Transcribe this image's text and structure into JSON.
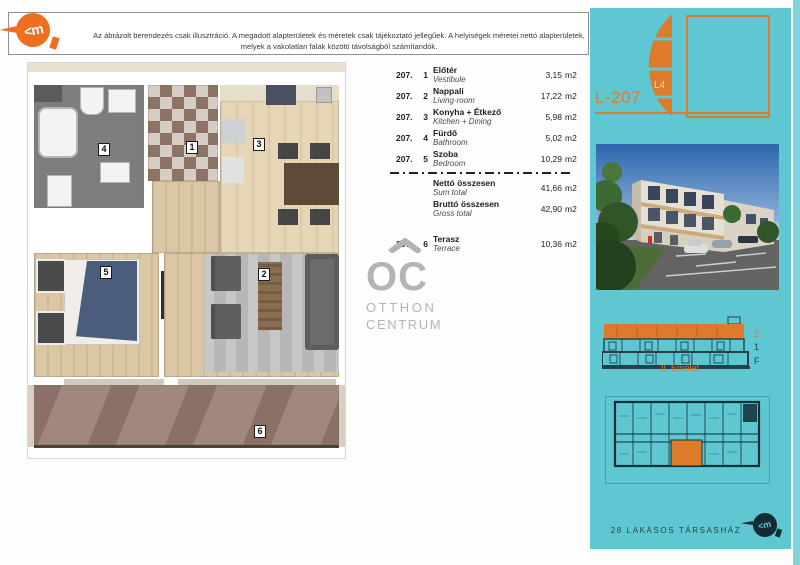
{
  "header": {
    "disclaimer_line1": "Az ábrázolt berendezés csak illusztráció. A megadott alapterületek és méretek csak tájékoztató jellegűek. A helyiségek méretei nettó alapterületek,",
    "disclaimer_line2": "melyek a vakolatlan falak közötti távolságból számítandók.",
    "logo_glyph": "<m"
  },
  "rooms_table": {
    "rows": [
      {
        "code": "207.",
        "no": "1",
        "name_hu": "Előtér",
        "name_en": "Vestibule",
        "area": "3,15",
        "unit": "m2"
      },
      {
        "code": "207.",
        "no": "2",
        "name_hu": "Nappali",
        "name_en": "Living-room",
        "area": "17,22",
        "unit": "m2"
      },
      {
        "code": "207.",
        "no": "3",
        "name_hu": "Konyha + Étkező",
        "name_en": "Kitchen + Dining",
        "area": "5,98",
        "unit": "m2"
      },
      {
        "code": "207.",
        "no": "4",
        "name_hu": "Fürdő",
        "name_en": "Bathroom",
        "area": "5,02",
        "unit": "m2"
      },
      {
        "code": "207.",
        "no": "5",
        "name_hu": "Szoba",
        "name_en": "Bedroom",
        "area": "10,29",
        "unit": "m2"
      }
    ],
    "totals": [
      {
        "name_hu": "Nettó összesen",
        "name_en": "Sum total",
        "area": "41,66",
        "unit": "m2"
      },
      {
        "name_hu": "Bruttó összesen",
        "name_en": "Gross total",
        "area": "42,90",
        "unit": "m2"
      }
    ],
    "extra": {
      "code": "207.",
      "no": "6",
      "name_hu": "Terasz",
      "name_en": "Terrace",
      "area": "10,36",
      "unit": "m2"
    }
  },
  "brand": {
    "initials": "OC",
    "line1": "OTTHON",
    "line2": "CENTRUM"
  },
  "floorplan": {
    "labels": [
      "1",
      "2",
      "3",
      "4",
      "5",
      "6"
    ]
  },
  "sidebar": {
    "unit_code": "L-207",
    "stack_label": "L4",
    "floors": [
      "2",
      "1",
      "F"
    ],
    "floor_caption": "II. Emelet",
    "footer_caption": "28 LAKÁSOS TÁRSASHÁZ",
    "logo_glyph": "<m"
  },
  "colors": {
    "accent_orange": "#dd7b2b",
    "logo_orange": "#ee6f1e",
    "panel_teal": "#5ec7d1",
    "dark_navy": "#1d3a46",
    "brand_gray": "#b4b4b4"
  }
}
